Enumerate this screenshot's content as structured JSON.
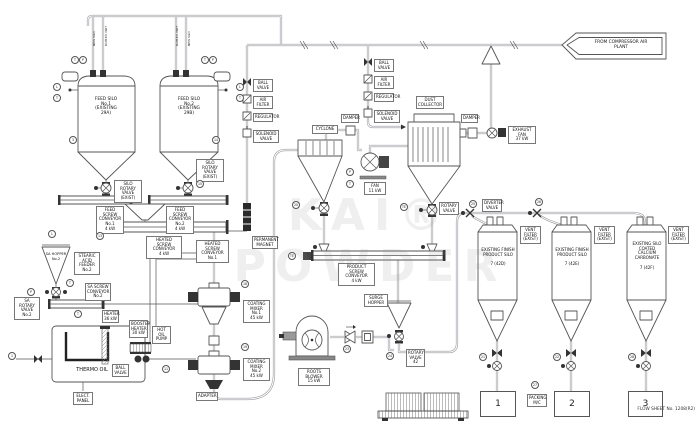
{
  "watermark": "KAI® POWDER",
  "flag": {
    "text": "FROM COMPRESSOR AIR\nPLANT"
  },
  "titleblock": {
    "flow_sheet": "FLOW SHEET  No. 1208(R2)"
  },
  "labels": {
    "feed_silo_1": "FEED SILO\nNo.1\n(EXISTING\n29A)",
    "feed_silo_2": "FEED SILO\nNo.2\n(EXISTING\n29B)",
    "riser_1a": "NEW SILO",
    "riser_1b": "DUPLEX UNIT",
    "riser_2a": "DUPLEX UNIT",
    "riser_2b": "NEW SILO",
    "silo_rv_1": "SILO ROTARY\nVALVE\n(EXIST)",
    "silo_rv_2": "SILO ROTARY\nVALVE\n(EXIST)",
    "feed_screw_1": "FEED SCREW\nCONVEYOR No.1\n4 kW",
    "feed_screw_2": "FEED SCREW\nCONVEYOR No.2\n4 kW",
    "screw_3": "HEATED SCREW\nCONVEYOR\nNo.1",
    "heated_screw": "HEATED\nSCREW CONVEYOR\n4 kW",
    "permanent_magnet": "PERMANENT\nMAGNET",
    "sa_hopper": "SA HOPPER\nNo.2",
    "sa_feeder": "STEARIC ACID\nFEEDER\nNo.2",
    "sa_rv": "SA ROTARY\nVALVE\nNo.2",
    "sa_screw": "SA SCREW\nCONVEYOR\nNo.2",
    "heater": "HEATER\n36 kW",
    "booster_heater": "BOOSTER\nHEATER\n30 kW",
    "hot_oil_pump": "HOT OIL\nPUMP",
    "ball_valve_thermo": "BALL VALVE",
    "thermo_oil": "THERMO OIL",
    "elect_panel": "ELECT.\nPANEL",
    "coating_mixer_1": "COATING\nMIXER No.1\n45 kW",
    "coating_mixer_2": "COATING\nMIXER No.2\n45 kW",
    "adapter": "ADAPTER",
    "roots_blower": "ROOTS\nBLOWER\n15 kW",
    "surge_hopper": "SURGE\nHOPPER",
    "rotary_valve_42": "ROTARY\nVALVE\n42",
    "product_screw": "PRODUCT SCREW\nCONVEYOR\n4 kW",
    "cyclone": "CYCLONE",
    "damper_1": "DAMPER",
    "fan": "FAN\n11 kW",
    "dust_collector": "DUST\nCOLLECTOR",
    "dc_rotary_valve": "ROTARY\nVALVE",
    "damper_2": "DAMPER",
    "exhaust_fan": "EXHAUST FAN\n37 kW",
    "ball_valve_1": "BALL VALVE",
    "air_filter_1": "AIR FILTER",
    "regulator_1": "REGULATOR",
    "solenoid_valve_1": "SOLENOID VALVE",
    "ball_valve_2": "BALL VALVE",
    "air_filter_2": "AIR FILTER",
    "regulator_2": "REGULATOR",
    "solenoid_valve_2": "SOLENOID VALVE",
    "silo_a": "EXISTING FINISH\nPRODUCT SILO\n\n7 (42D)",
    "silo_b": "EXISTING FINISH\nPRODUCT SILO\n\n7 (42E)",
    "silo_c": "EXISTING SILO\nCOATED\nCALCIUM\nCARBONATE\n\n7 (42F)",
    "vent_filter_a": "VENT\nFILTER\n(EXIST)",
    "vent_filter_b": "VENT\nFILTER\n(EXIST)",
    "vent_filter_c": "VENT\nFILTER\n(EXIST)",
    "diverter_valve": "DIVERTER\nVALVE",
    "packing_mc": "PACKING\nM/C",
    "station_1": "1",
    "station_2": "2",
    "station_3": "3"
  },
  "instruments": {
    "b1": "T",
    "b2": "P",
    "b3": "T",
    "b4": "P",
    "b5": "L",
    "b6": "T",
    "b7": "L",
    "b8": "T",
    "b9": "3",
    "b10": "14",
    "b11": "15",
    "b12": "13",
    "b13": "L",
    "b14": "P",
    "b15": "T",
    "b16": "T",
    "b17": "11",
    "b18": "1",
    "b19": "18",
    "b20": "19",
    "b21": "20",
    "b22": "TE",
    "b23": "P",
    "b24": "T",
    "b25": "TE",
    "b26": "23",
    "b27": "24",
    "b28": "25",
    "b29": "26",
    "b30": "27",
    "b31": "21",
    "b32": "22",
    "b33": "28"
  }
}
